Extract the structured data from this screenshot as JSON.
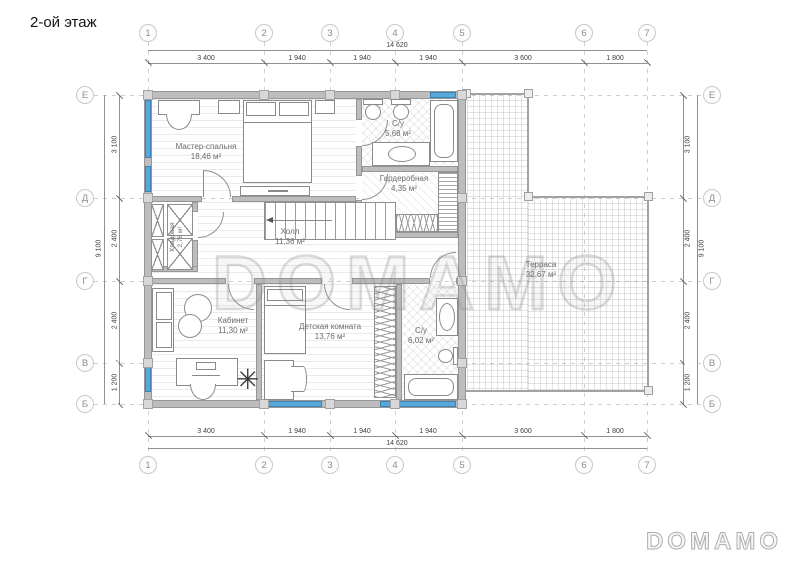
{
  "title": "2-ой этаж",
  "watermark": {
    "main": "DOMAMO",
    "logo": "DOMAMO"
  },
  "axes": {
    "columns": [
      "1",
      "2",
      "3",
      "4",
      "5",
      "6",
      "7"
    ],
    "rows": [
      "Е",
      "Д",
      "Г",
      "В",
      "Б"
    ]
  },
  "dims": {
    "total_width": "14 620",
    "top_segments": [
      "3 400",
      "1 940",
      "1 940",
      "1 940",
      "3 600",
      "1 800"
    ],
    "total_height": "9 100",
    "side_segments": [
      "3 100",
      "2 400",
      "2 400",
      "1 200"
    ]
  },
  "rooms": {
    "master": {
      "name": "Мастер-спальня",
      "area": "18,46 м²"
    },
    "bath1": {
      "name": "С/у",
      "area": "5,68 м²"
    },
    "wardrobe": {
      "name": "Гардеробная",
      "area": "4,35 м²"
    },
    "closet": {
      "name": "Кладовая",
      "area": "2,76 м²"
    },
    "hall": {
      "name": "Холл",
      "area": "11,36 м²"
    },
    "office": {
      "name": "Кабинет",
      "area": "11,30 м²"
    },
    "kids": {
      "name": "Детская комната",
      "area": "13,76 м²"
    },
    "bath2": {
      "name": "С/у",
      "area": "6,02 м²"
    },
    "terrace": {
      "name": "Терраса",
      "area": "32,67 м²"
    }
  },
  "colors": {
    "window": "#58a8dc",
    "wall": "#bdbdbd",
    "axis_circle": "#c9c9c9"
  }
}
